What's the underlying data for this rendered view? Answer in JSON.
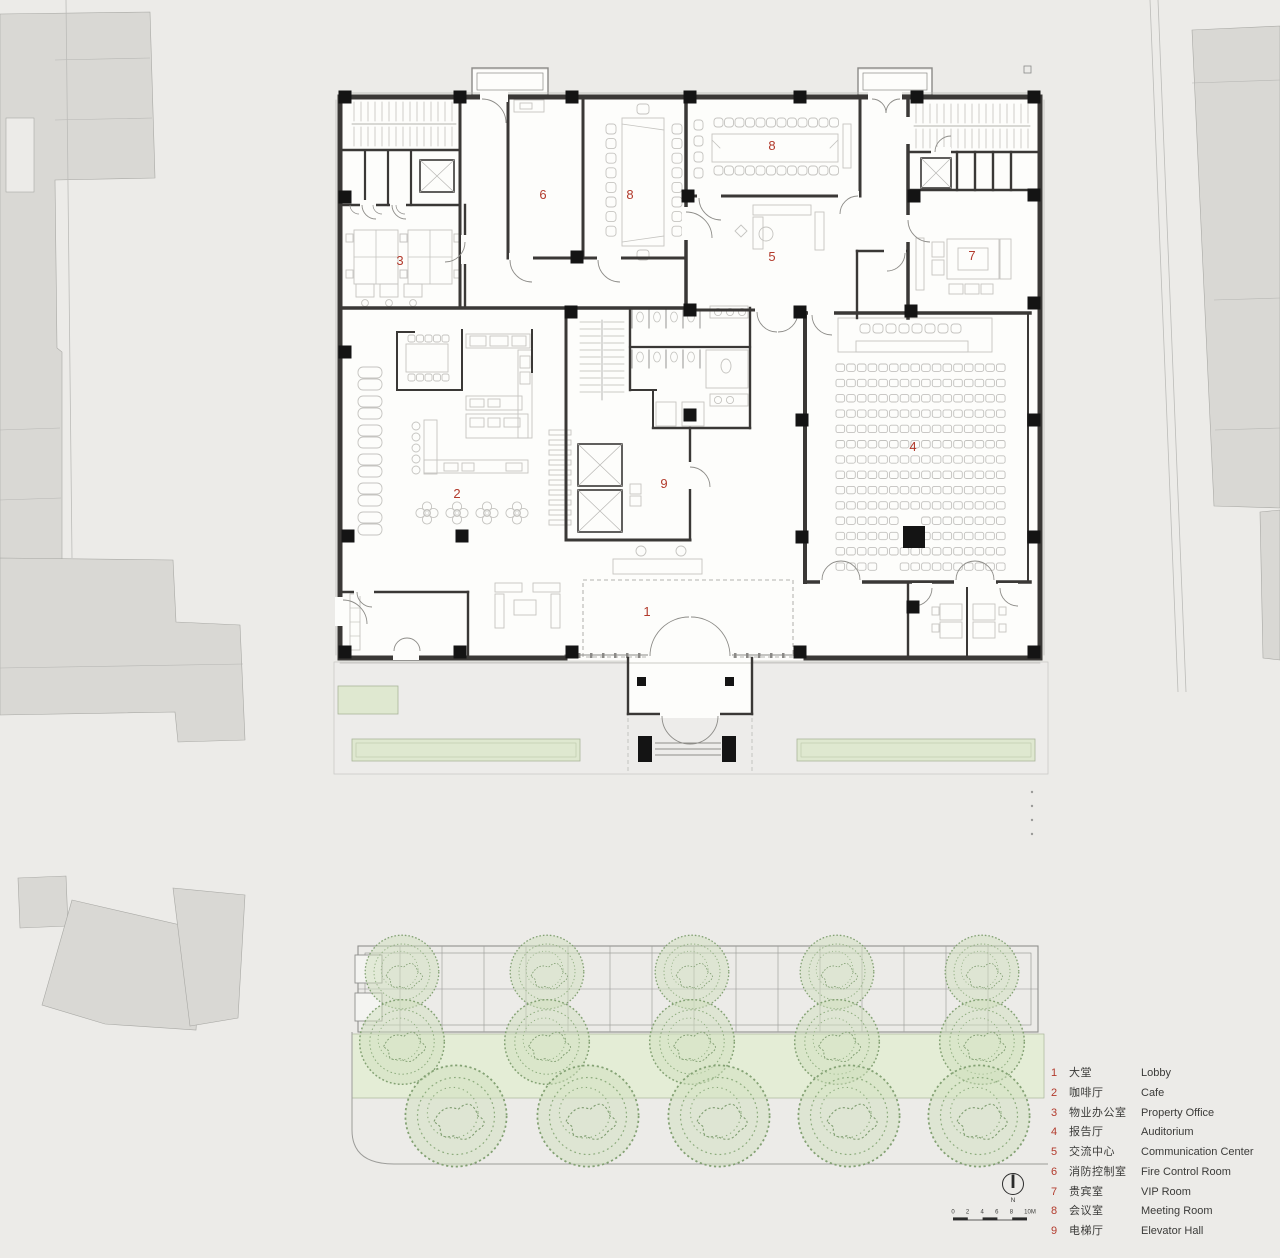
{
  "page": {
    "background": "#ecebe8"
  },
  "plan": {
    "label_color": "#b23a2c",
    "room_labels": [
      {
        "num": "1"
      },
      {
        "num": "2"
      },
      {
        "num": "3"
      },
      {
        "num": "4"
      },
      {
        "num": "5"
      },
      {
        "num": "6"
      },
      {
        "num": "7"
      },
      {
        "num": "8"
      },
      {
        "num": "8"
      },
      {
        "num": "9"
      }
    ]
  },
  "legend": {
    "items": [
      {
        "num": "1",
        "zh": "大堂",
        "en": "Lobby"
      },
      {
        "num": "2",
        "zh": "咖啡厅",
        "en": "Cafe"
      },
      {
        "num": "3",
        "zh": "物业办公室",
        "en": "Property Office"
      },
      {
        "num": "4",
        "zh": "报告厅",
        "en": "Auditorium"
      },
      {
        "num": "5",
        "zh": "交流中心",
        "en": "Communication Center"
      },
      {
        "num": "6",
        "zh": "消防控制室",
        "en": "Fire Control Room"
      },
      {
        "num": "7",
        "zh": "贵宾室",
        "en": "VIP Room"
      },
      {
        "num": "8",
        "zh": "会议室",
        "en": "Meeting Room"
      },
      {
        "num": "9",
        "zh": "电梯厅",
        "en": "Elevator Hall"
      }
    ]
  },
  "compass": {
    "label": "N"
  },
  "scale_bar": {
    "labels": [
      "0",
      "2",
      "4",
      "6",
      "8",
      "10M"
    ]
  },
  "colors": {
    "wall": "#3a3836",
    "column": "#141414",
    "furniture": "#c5c4c0",
    "context_building": "#d9d8d4",
    "planter_green": "#dfe8d0",
    "lawn_green": "#e4edd6",
    "tree_green": "#7e9c6f",
    "room_number_red": "#b23a2c"
  }
}
